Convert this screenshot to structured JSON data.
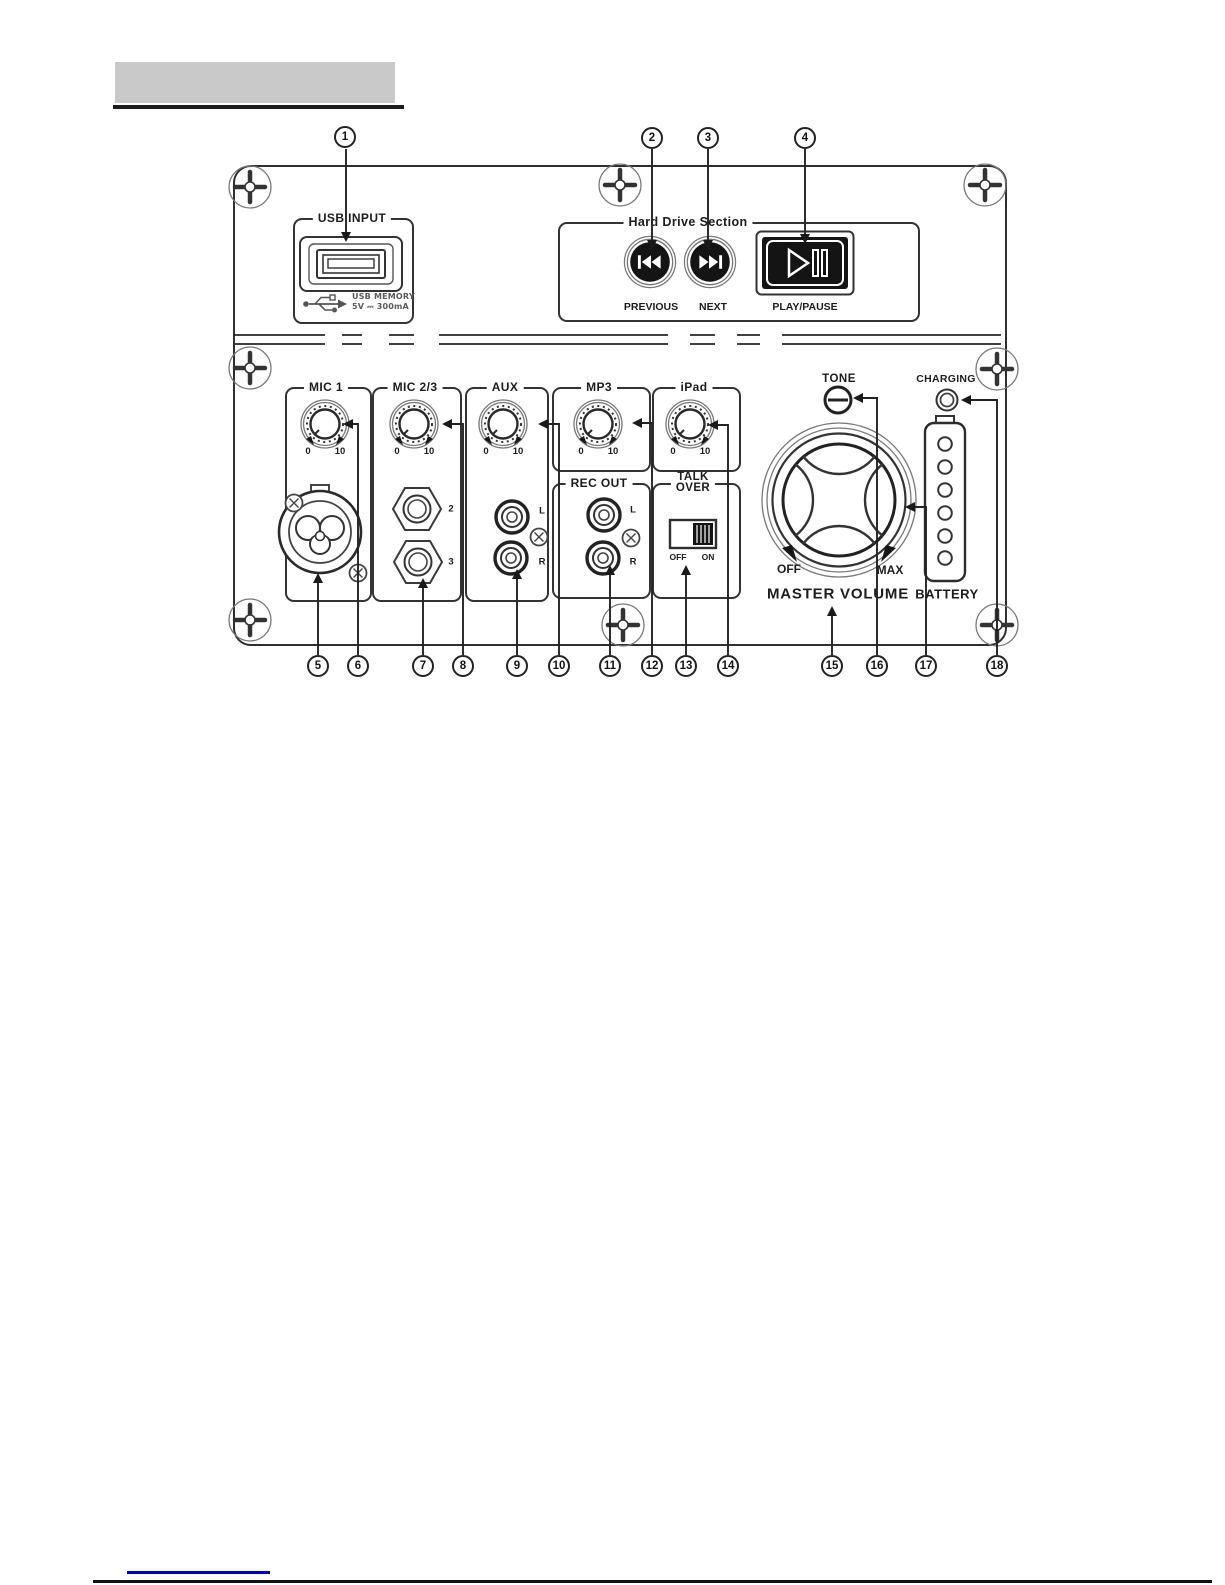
{
  "callouts": [
    "1",
    "2",
    "3",
    "4",
    "5",
    "6",
    "7",
    "8",
    "9",
    "10",
    "11",
    "12",
    "13",
    "14",
    "15",
    "16",
    "17",
    "18"
  ],
  "panel": {
    "usb": {
      "legend": "USB INPUT",
      "memory_line1": "USB MEMORY",
      "memory_line2": "5V ⎓ 300mA"
    },
    "hard_drive": {
      "legend": "Hard Drive Section",
      "previous_label": "PREVIOUS",
      "next_label": "NEXT",
      "play_pause_label": "PLAY/PAUSE"
    },
    "knob_scale": {
      "min": "0",
      "max": "10"
    },
    "mic1": {
      "legend": "MIC 1"
    },
    "mic23": {
      "legend": "MIC 2/3",
      "jack2_label": "2",
      "jack3_label": "3"
    },
    "aux": {
      "legend": "AUX",
      "left_label": "L",
      "right_label": "R"
    },
    "mp3": {
      "legend": "MP3"
    },
    "ipad": {
      "legend": "iPad"
    },
    "rec_out": {
      "legend": "REC OUT",
      "left_label": "L",
      "right_label": "R"
    },
    "talk_over": {
      "legend_line1": "TALK",
      "legend_line2": "OVER",
      "off_label": "OFF",
      "on_label": "ON"
    },
    "tone_label": "TONE",
    "charging_label": "CHARGING",
    "master_volume": {
      "off_label": "OFF",
      "max_label": "MAX",
      "label": "MASTER VOLUME"
    },
    "battery_label": "BATTERY"
  }
}
